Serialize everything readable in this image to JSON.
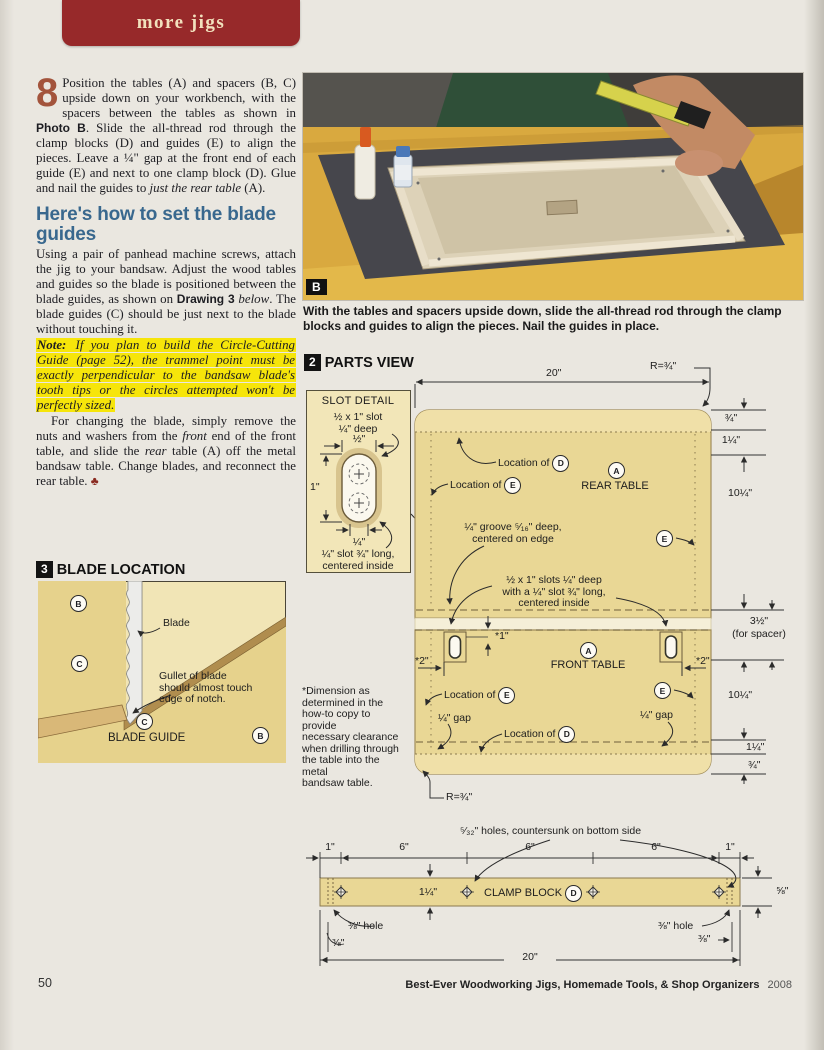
{
  "page": {
    "tab_label": "more jigs",
    "page_number": "50",
    "footer_title": "Best-Ever Woodworking Jigs, Homemade Tools, & Shop Organizers",
    "footer_year": "2008"
  },
  "letters": {
    "a": "A",
    "b": "B",
    "c": "C",
    "d": "D",
    "e": "E"
  },
  "article": {
    "step_number": "8",
    "step_1": "Position the tables (A) and spacers (B, C) upside down on your workbench, with the spacers between the tables as shown in ",
    "step_bold": "Photo B",
    "step_2": ". Slide the all-thread rod through the clamp blocks (D) and guides (E) to align the pieces. Leave a ¼\" gap at the front end of each guide (E) and next to one clamp block (D). Glue and nail the guides to ",
    "step_italic": "just the rear table",
    "step_3": " (A).",
    "heading": "Here's how to set the blade guides",
    "p2_1": "Using a pair of panhead machine screws, attach the jig to your bandsaw. Adjust the wood tables and guides so the blade is positioned between the blade guides, as shown on ",
    "p2_bold": "Drawing 3",
    "p2_2": " ",
    "p2_italic": "below",
    "p2_3": ". The blade guides (C) should be just next to the blade without touching it.",
    "note_label": "Note:",
    "note_text": " If you plan to build the Circle-Cutting Guide (page 52), the trammel point must be exactly perpendicular to the bandsaw blade's tooth tips or the circles attempted won't be perfectly sized.",
    "p3_1": "For changing the blade, simply remove the nuts and washers from the ",
    "p3_italic1": "front",
    "p3_2": " end of the front table, and slide the ",
    "p3_italic2": "rear",
    "p3_3": " table (A) off the metal bandsaw table. Change blades, and reconnect the rear table. ",
    "end_mark": "♣"
  },
  "photo": {
    "label": "B",
    "caption": "With the tables and spacers upside down, slide the all-thread rod through the clamp blocks and guides to align the pieces. Nail the guides in place."
  },
  "drawing3": {
    "number": "3",
    "title": "BLADE LOCATION",
    "blade": "Blade",
    "gullet": "Gullet of blade\nshould almost touch\nedge of notch.",
    "blade_guide": "BLADE GUIDE"
  },
  "parts_view": {
    "number": "2",
    "title": "PARTS VIEW",
    "slot_detail": {
      "title": "SLOT DETAIL",
      "top_note": "½ x 1\" slot\n¼\" deep",
      "dim_half": "½\"",
      "dim_one": "1\"",
      "dim_quarter": "¼\"",
      "bottom_note": "¼\" slot ¾\" long,\ncentered inside"
    },
    "dims": {
      "top_radius": "R=¾\"",
      "top_width": "20\"",
      "r1": "¾\"",
      "r2": "1¼\"",
      "r3": "10¼\"",
      "r4": "3½\"",
      "r4b": "(for spacer)",
      "r5": "10¼\"",
      "r6": "1¼\"",
      "r7": "¾\"",
      "bottom_radius": "R=¾\"",
      "star1": "*1\"",
      "star2": "*2\""
    },
    "labels": {
      "location_of": "Location of",
      "rear_table": "REAR TABLE",
      "front_table": "FRONT TABLE",
      "groove": "¼\" groove ⁵⁄₁₆\" deep,\ncentered on edge",
      "slots": "½ x 1\" slots ¼\" deep\nwith a ¼\" slot ¾\" long,\ncentered inside",
      "gap": "¼\" gap",
      "asterisk_note": "*Dimension as\ndetermined in the\nhow-to copy to provide\nnecessary clearance\nwhen drilling through\nthe table into the metal\nbandsaw table."
    }
  },
  "clamp_block": {
    "holes_note": "⁵⁄₃₂\" holes, countersunk on bottom side",
    "dim_1": "1\"",
    "dim_6": "6\"",
    "dim_width": "1¼\"",
    "name": "CLAMP BLOCK",
    "dim_58": "⅝\"",
    "hole_38": "⅜\" hole",
    "dim_38": "⅜\"",
    "dim_total": "20\""
  }
}
